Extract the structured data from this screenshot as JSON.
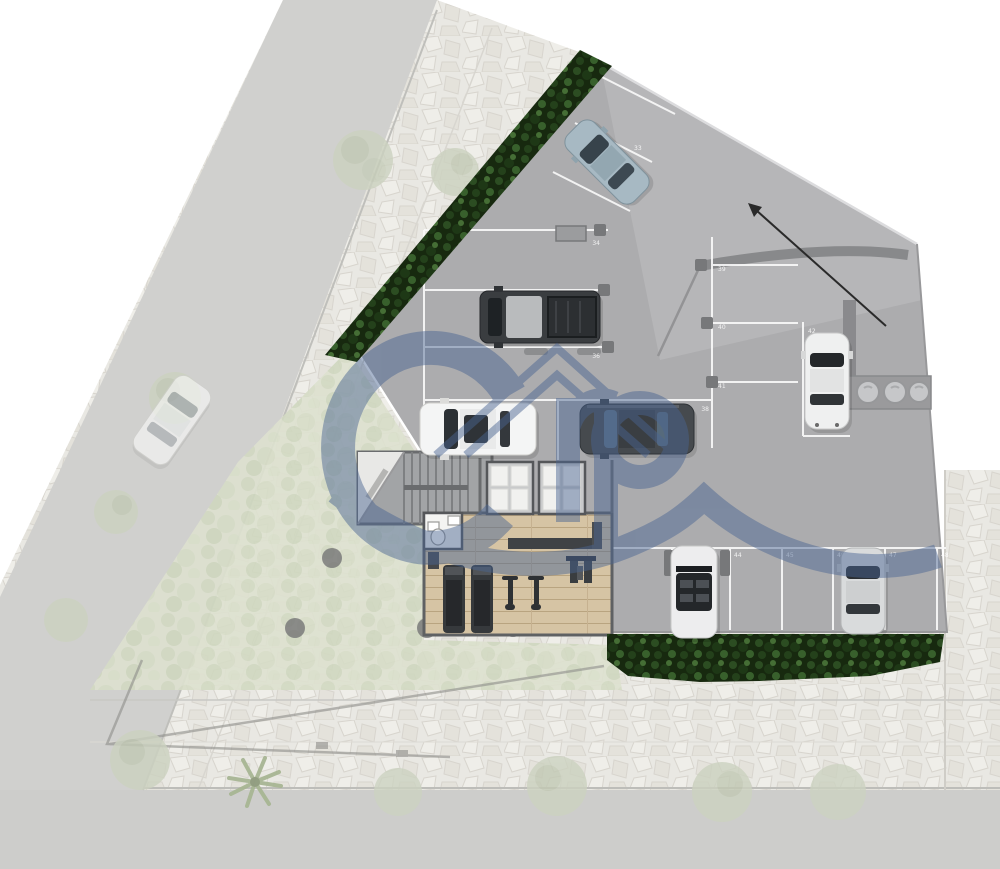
{
  "plan": {
    "kind": "site-plan",
    "watermark": {
      "icon": "house-roof-logo-icon",
      "letters": "rp",
      "color": "#4a6592"
    }
  },
  "palette": {
    "slab": "#acacae",
    "slab_light": "#b6b6b8",
    "ramp_wall": "#88898b",
    "hedge": "#17290f",
    "wood_floor": "#d6c4a4",
    "stone_sidewalk": "#e9e8e3",
    "road_faded": "#d0d0ce",
    "garden_faded": "#dde1cf",
    "stall_line": "#fafafa"
  },
  "parking": {
    "angled": {
      "stalls": [
        "33"
      ]
    },
    "left_column": {
      "stalls": [
        "34",
        "35",
        "36"
      ]
    },
    "center": {
      "stalls": [
        "37",
        "38"
      ]
    },
    "ramp_column": {
      "stalls": [
        "39",
        "40",
        "41"
      ]
    },
    "right_single": {
      "stalls": [
        "42"
      ]
    },
    "bottom_row": {
      "stalls": [
        "43",
        "44",
        "45",
        "46",
        "47",
        "48"
      ]
    }
  },
  "vehicles": [
    {
      "name": "sedan-angled-blue-gray",
      "color": "#a7b9c3"
    },
    {
      "name": "pickup-truck-dark",
      "color": "#3a3d40"
    },
    {
      "name": "sedan-white-sunroof",
      "color": "#f4f5f5"
    },
    {
      "name": "sedan-dark-gray",
      "color": "#464a4e"
    },
    {
      "name": "coupe-white-right",
      "color": "#eff0f0"
    },
    {
      "name": "convertible-white",
      "color": "#ededee"
    },
    {
      "name": "hatchback-silver",
      "color": "#d9dbdc"
    },
    {
      "name": "street-car-white-faded",
      "color": "#fafafa"
    }
  ],
  "amenities": {
    "gym_equipment": [
      "treadmill",
      "treadmill",
      "exercise-bike",
      "exercise-bike",
      "weight-machine"
    ],
    "restroom_fixtures": [
      "toilet",
      "sink"
    ],
    "utility_drums": "3"
  },
  "ramp": {
    "direction_arrow": "up-left"
  },
  "landscape": {
    "hedges": "2",
    "street_trees": "10",
    "palm_trees": "1",
    "planting_dots": "4"
  }
}
